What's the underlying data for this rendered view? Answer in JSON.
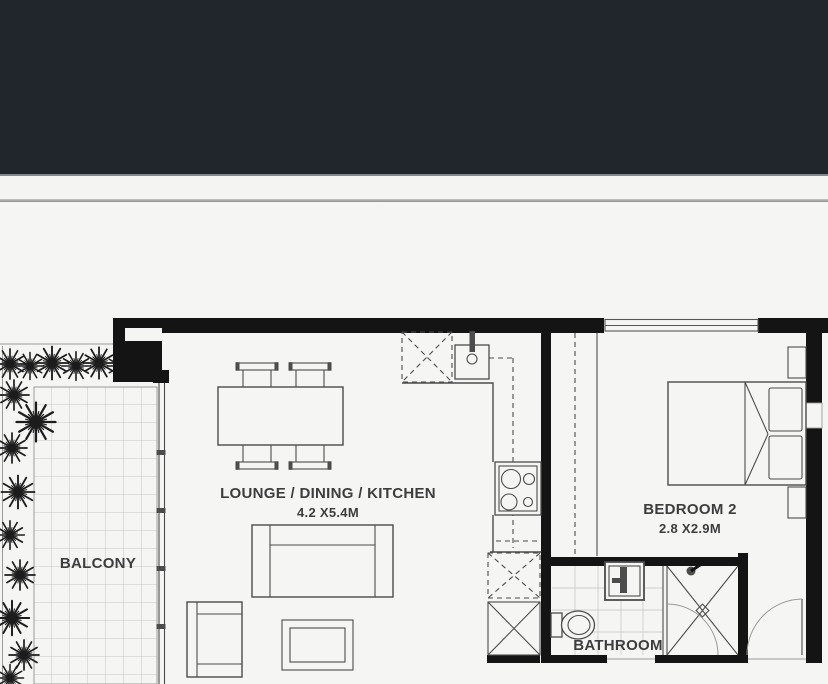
{
  "floorplan": {
    "balcony": {
      "label": "BALCONY"
    },
    "lounge": {
      "label": "LOUNGE / DINING / KITCHEN",
      "dims": "4.2 X5.4M"
    },
    "bedroom": {
      "label": "BEDROOM 2",
      "dims": "2.8 X2.9M"
    },
    "bathroom": {
      "label": "BATHROOM"
    },
    "colors": {
      "band": "#21262d",
      "paper": "#f5f5f3",
      "wall": "#141414",
      "line": "#4c4c4c",
      "tile": "#b9b9b9",
      "text": "#3d3d3d",
      "divider": "#8f8f8f"
    }
  }
}
